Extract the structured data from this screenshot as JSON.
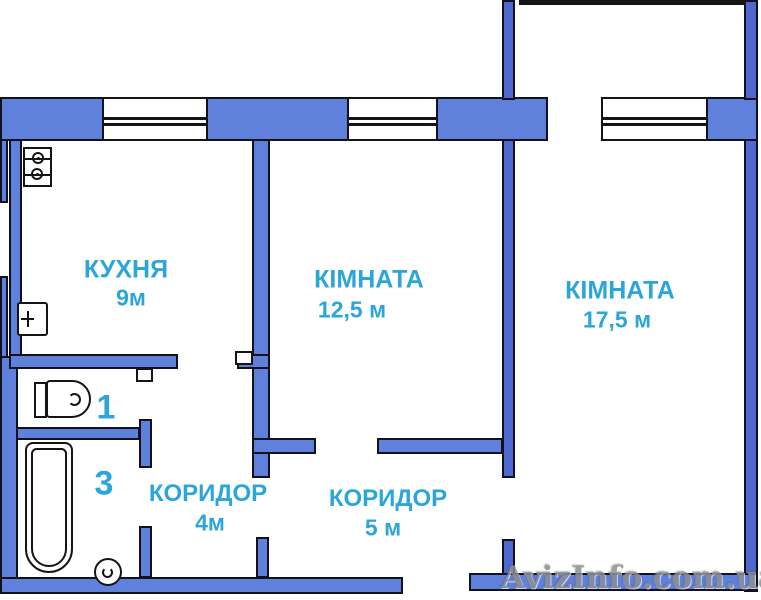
{
  "rooms": {
    "kitchen": {
      "name": "КУХНЯ",
      "area": "9м"
    },
    "room_medium": {
      "name": "КІМНАТА",
      "area": "12,5 м"
    },
    "room_large": {
      "name": "КІМНАТА",
      "area": "17,5 м"
    },
    "corridor_small": {
      "name": "КОРИДОР",
      "area": "4м"
    },
    "corridor_large": {
      "name": "КОРИДОР",
      "area": "5 м"
    },
    "wc": {
      "number": "1"
    },
    "bathroom": {
      "number": "3"
    }
  },
  "fixtures": [
    "stove",
    "kitchen-sink",
    "toilet",
    "bathtub",
    "washbasin",
    "door-leaf-kitchen",
    "door-leaf-wc"
  ],
  "windows": [
    "kitchen-window",
    "room-medium-window",
    "balcony-window"
  ],
  "watermark": {
    "text": "AvizInfo.com.ua",
    "color": "#8f8f8f"
  },
  "colors": {
    "wall_fill": "#5f80db",
    "wall_fill_dark": "#4f68cf",
    "outline": "#151515",
    "label_text": "#2ba6da",
    "background": "#ffffff"
  }
}
